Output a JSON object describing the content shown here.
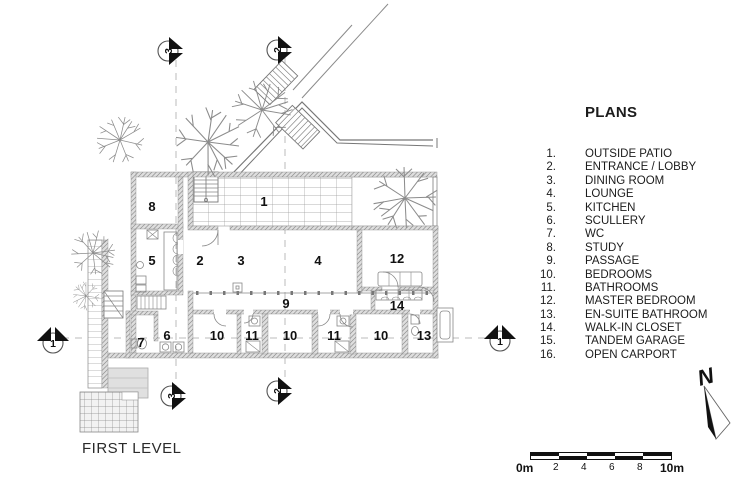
{
  "plan_title": "FIRST LEVEL",
  "legend": {
    "heading": "PLANS",
    "items": [
      {
        "num": "1.",
        "label": "OUTSIDE PATIO"
      },
      {
        "num": "2.",
        "label": "ENTRANCE / LOBBY"
      },
      {
        "num": "3.",
        "label": "DINING ROOM"
      },
      {
        "num": "4.",
        "label": "LOUNGE"
      },
      {
        "num": "5.",
        "label": "KITCHEN"
      },
      {
        "num": "6.",
        "label": "SCULLERY"
      },
      {
        "num": "7.",
        "label": "WC"
      },
      {
        "num": "8.",
        "label": "STUDY"
      },
      {
        "num": "9.",
        "label": "PASSAGE"
      },
      {
        "num": "10.",
        "label": "BEDROOMS"
      },
      {
        "num": "11.",
        "label": "BATHROOMS"
      },
      {
        "num": "12.",
        "label": "MASTER BEDROOM"
      },
      {
        "num": "13.",
        "label": "EN-SUITE BATHROOM"
      },
      {
        "num": "14.",
        "label": "WALK-IN CLOSET"
      },
      {
        "num": "15.",
        "label": "TANDEM GARAGE"
      },
      {
        "num": "16.",
        "label": "OPEN CARPORT"
      }
    ]
  },
  "plan": {
    "room_labels": {
      "patio": "1",
      "entrance": "2",
      "dining": "3",
      "lounge": "4",
      "kitchen": "5",
      "scullery": "6",
      "wc": "7",
      "study": "8",
      "passage": "9",
      "bedroom_a": "10",
      "bathroom_a": "11",
      "bedroom_b": "10",
      "bathroom_b": "11",
      "bedroom_c": "10",
      "master": "12",
      "ensuite": "13",
      "closet": "14"
    },
    "section_markers": {
      "top_3": "3",
      "top_2": "2",
      "bottom_3": "3",
      "bottom_2": "2",
      "left_1": "1",
      "right_1": "1"
    }
  },
  "scale_bar": {
    "start_label": "0m",
    "tick_labels": [
      "2",
      "4",
      "6",
      "8"
    ],
    "end_label": "10m"
  },
  "north_label": "N",
  "colors": {
    "line": "#777777",
    "wall_hatch": "#8f8f8f",
    "dash": "#bbbbbb",
    "text": "#1c1c1c"
  }
}
